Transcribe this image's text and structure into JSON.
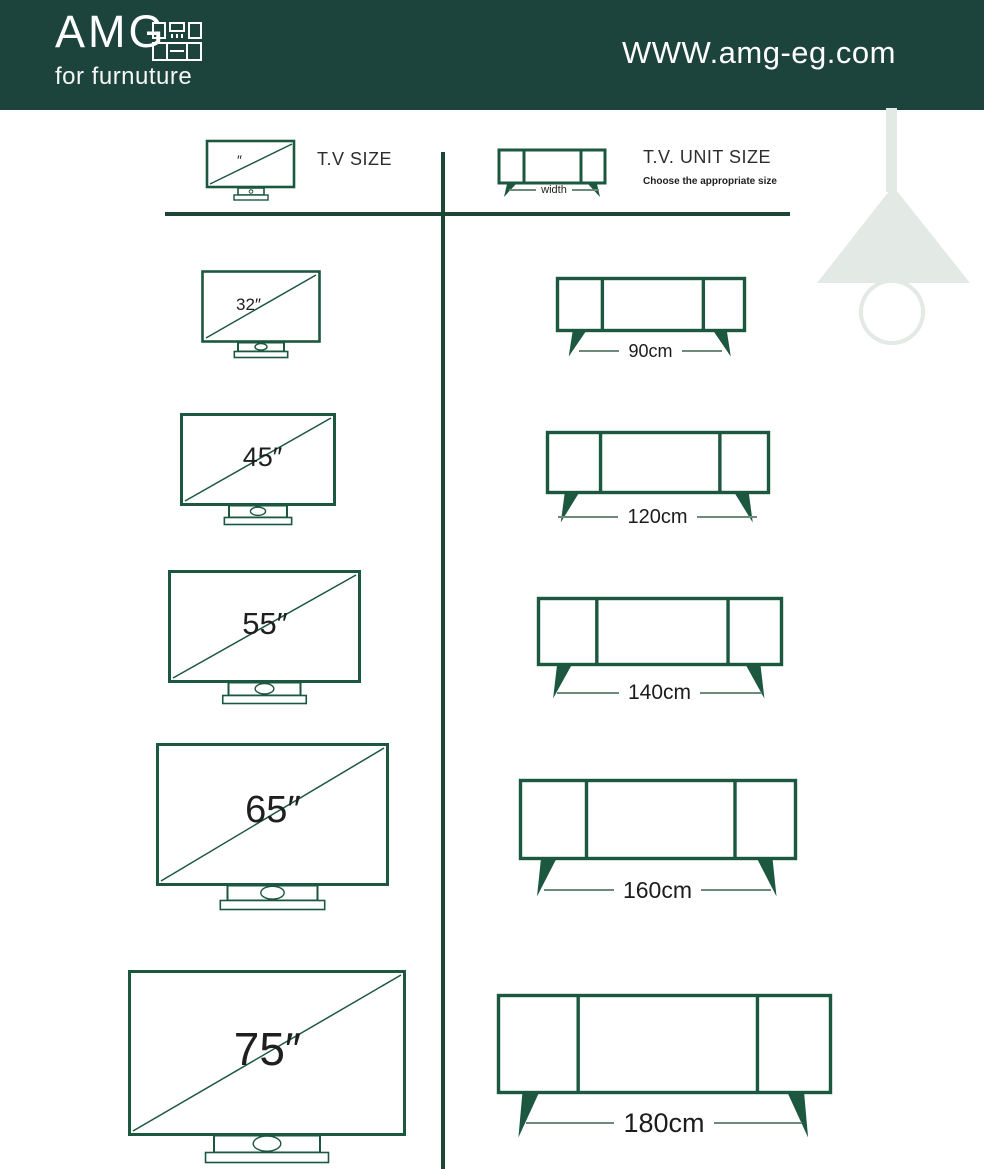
{
  "header": {
    "logo_text": "AMG",
    "logo_subtitle": "for furnuture",
    "website": "WWW.amg-eg.com"
  },
  "legend": {
    "tv_label": "T.V SIZE",
    "tv_icon_mark": "″",
    "unit_label": "T.V. UNIT SIZE",
    "unit_sublabel": "Choose the appropriate size",
    "width_label": "width"
  },
  "rows": [
    {
      "tv_size": "32″",
      "unit_width": "90cm"
    },
    {
      "tv_size": "45″",
      "unit_width": "120cm"
    },
    {
      "tv_size": "55″",
      "unit_width": "140cm"
    },
    {
      "tv_size": "65″",
      "unit_width": "160cm"
    },
    {
      "tv_size": "75″",
      "unit_width": "180cm"
    }
  ],
  "colors": {
    "header_bg": "#1d443c",
    "outline_green": "#1c5740",
    "rule_green": "#1b4734",
    "label_ink": "#222222",
    "dash_line": "#6e8a7b",
    "lamp_pale": "#e3e9e5"
  }
}
